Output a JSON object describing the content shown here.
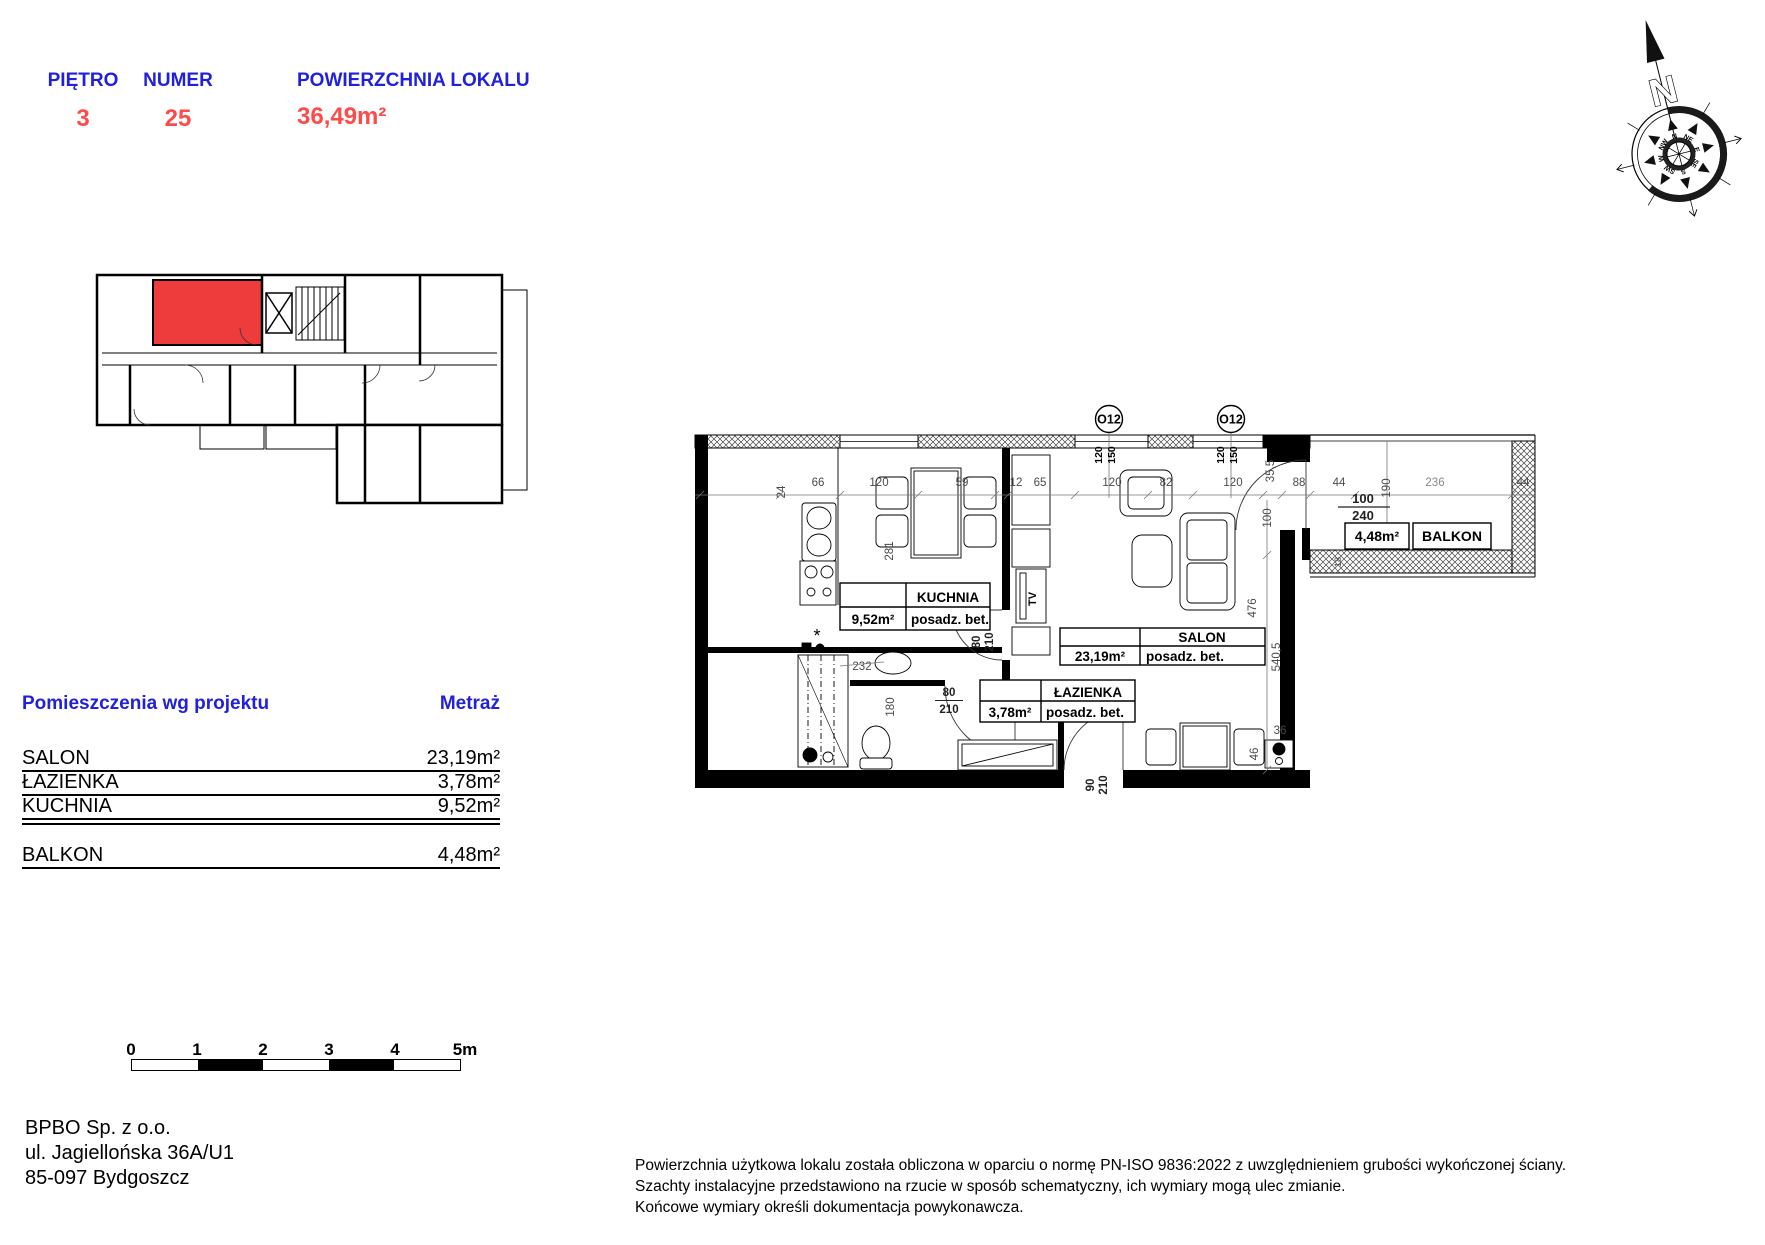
{
  "header": {
    "cells": [
      {
        "label": "PIĘTRO",
        "value": "3"
      },
      {
        "label": "NUMER",
        "value": "25"
      },
      {
        "label": "POWIERZCHNIA LOKALU",
        "value": "36,49m²"
      }
    ],
    "label_color": "#2020dd",
    "value_color": "#ff4a4a"
  },
  "overview": {
    "highlight_color": "#ee3c3c"
  },
  "compass": {
    "letter": "N",
    "dirs": [
      "N",
      "NE",
      "E",
      "SE",
      "S",
      "SW",
      "W",
      "NW"
    ]
  },
  "plan": {
    "marks": [
      "O12",
      "O12"
    ],
    "mark_dims": [
      "120",
      "150"
    ],
    "dims_top": [
      "24",
      "66",
      "120",
      "59",
      "12",
      "65",
      "120",
      "82",
      "120",
      "35,5",
      "88",
      "44"
    ],
    "dims_right": [
      "100",
      "476",
      "540,5",
      "36",
      "46"
    ],
    "dims_inner": [
      "281",
      "232",
      "180"
    ],
    "balcony": {
      "door_w": "100",
      "door_h": "240",
      "depth": "190",
      "width": "236",
      "side": "44",
      "bottom": "18"
    },
    "doors": {
      "kitchen_w": "80",
      "kitchen_h": "210",
      "bath_w": "80",
      "bath_h": "210",
      "entry_w": "90",
      "entry_h": "210"
    },
    "tv": "TV",
    "rooms": [
      {
        "name": "KUCHNIA",
        "area": "9,52m²",
        "floor": "posadz. bet."
      },
      {
        "name": "SALON",
        "area": "23,19m²",
        "floor": "posadz. bet."
      },
      {
        "name": "ŁAZIENKA",
        "area": "3,78m²",
        "floor": "posadz. bet."
      },
      {
        "name": "BALKON",
        "area": "4,48m²"
      }
    ]
  },
  "rooms_table": {
    "header": {
      "name": "Pomieszczenia wg projektu",
      "area": "Metraż"
    },
    "rows": [
      {
        "name": "SALON",
        "area": "23,19m²"
      },
      {
        "name": "ŁAZIENKA",
        "area": "3,78m²"
      },
      {
        "name": "KUCHNIA",
        "area": "9,52m²"
      },
      {
        "name": "BALKON",
        "area": "4,48m²"
      }
    ]
  },
  "scalebar": {
    "labels": [
      "0",
      "1",
      "2",
      "3",
      "4",
      "5m"
    ]
  },
  "address": {
    "line1": "BPBO Sp. z o.o.",
    "line2": "ul. Jagiellońska 36A/U1",
    "line3": "85-097 Bydgoszcz"
  },
  "disclaimer": {
    "line1": "Powierzchnia użytkowa lokalu została obliczona w oparciu o normę PN-ISO 9836:2022 z uwzględnieniem grubości wykończonej ściany.",
    "line2": "Szachty instalacyjne przedstawiono na rzucie w sposób schematyczny, ich wymiary mogą ulec zmianie.",
    "line3": "Końcowe wymiary określi dokumentacja powykonawcza."
  }
}
